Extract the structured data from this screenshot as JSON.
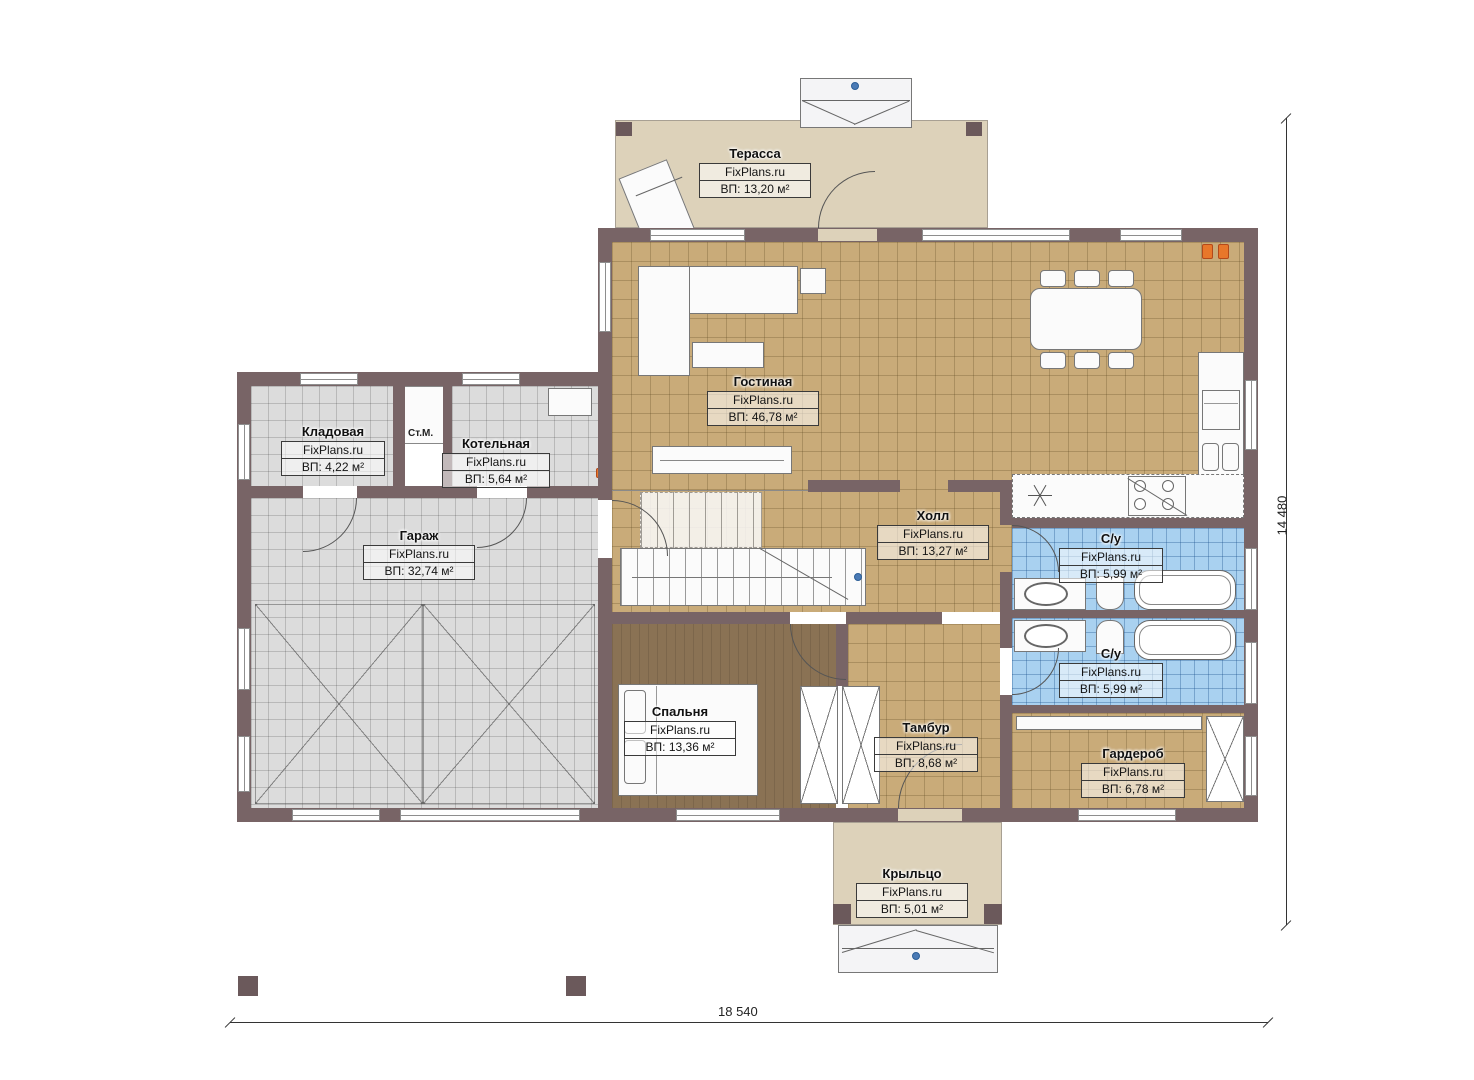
{
  "plan": {
    "brand": "FixPlans.ru",
    "rooms": [
      {
        "id": "terrace",
        "name": "Терасса",
        "area": "ВП: 13,20 м²"
      },
      {
        "id": "living",
        "name": "Гостиная",
        "area": "ВП: 46,78 м²"
      },
      {
        "id": "storage",
        "name": "Кладовая",
        "area": "ВП: 4,22 м²"
      },
      {
        "id": "boiler",
        "name": "Котельная",
        "area": "ВП: 5,64 м²"
      },
      {
        "id": "garage",
        "name": "Гараж",
        "area": "ВП: 32,74 м²"
      },
      {
        "id": "hall",
        "name": "Холл",
        "area": "ВП: 13,27 м²"
      },
      {
        "id": "bath1",
        "name": "С/у",
        "area": "ВП: 5,99 м²"
      },
      {
        "id": "bath2",
        "name": "С/у",
        "area": "ВП: 5,99 м²"
      },
      {
        "id": "bedroom",
        "name": "Спальня",
        "area": "ВП: 13,36 м²"
      },
      {
        "id": "vestibule",
        "name": "Тамбур",
        "area": "ВП: 8,68 м²"
      },
      {
        "id": "wardrobe",
        "name": "Гардероб",
        "area": "ВП: 6,78 м²"
      },
      {
        "id": "porch",
        "name": "Крыльцо",
        "area": "ВП: 5,01 м²"
      }
    ],
    "annotations": {
      "washing_machine": "Ст.М."
    },
    "dimensions": {
      "overall_width": "18 540",
      "overall_height": "14 480"
    },
    "colors": {
      "wall": "#786466",
      "floor_tan": "#c9ab79",
      "floor_gray": "#dcdcdc",
      "floor_blue": "#a9d1f0",
      "floor_beige": "#ddd2ba",
      "floor_wood": "#8a7254",
      "radiator_orange": "#e8772a",
      "marker_blue": "#4a7ab5"
    }
  }
}
